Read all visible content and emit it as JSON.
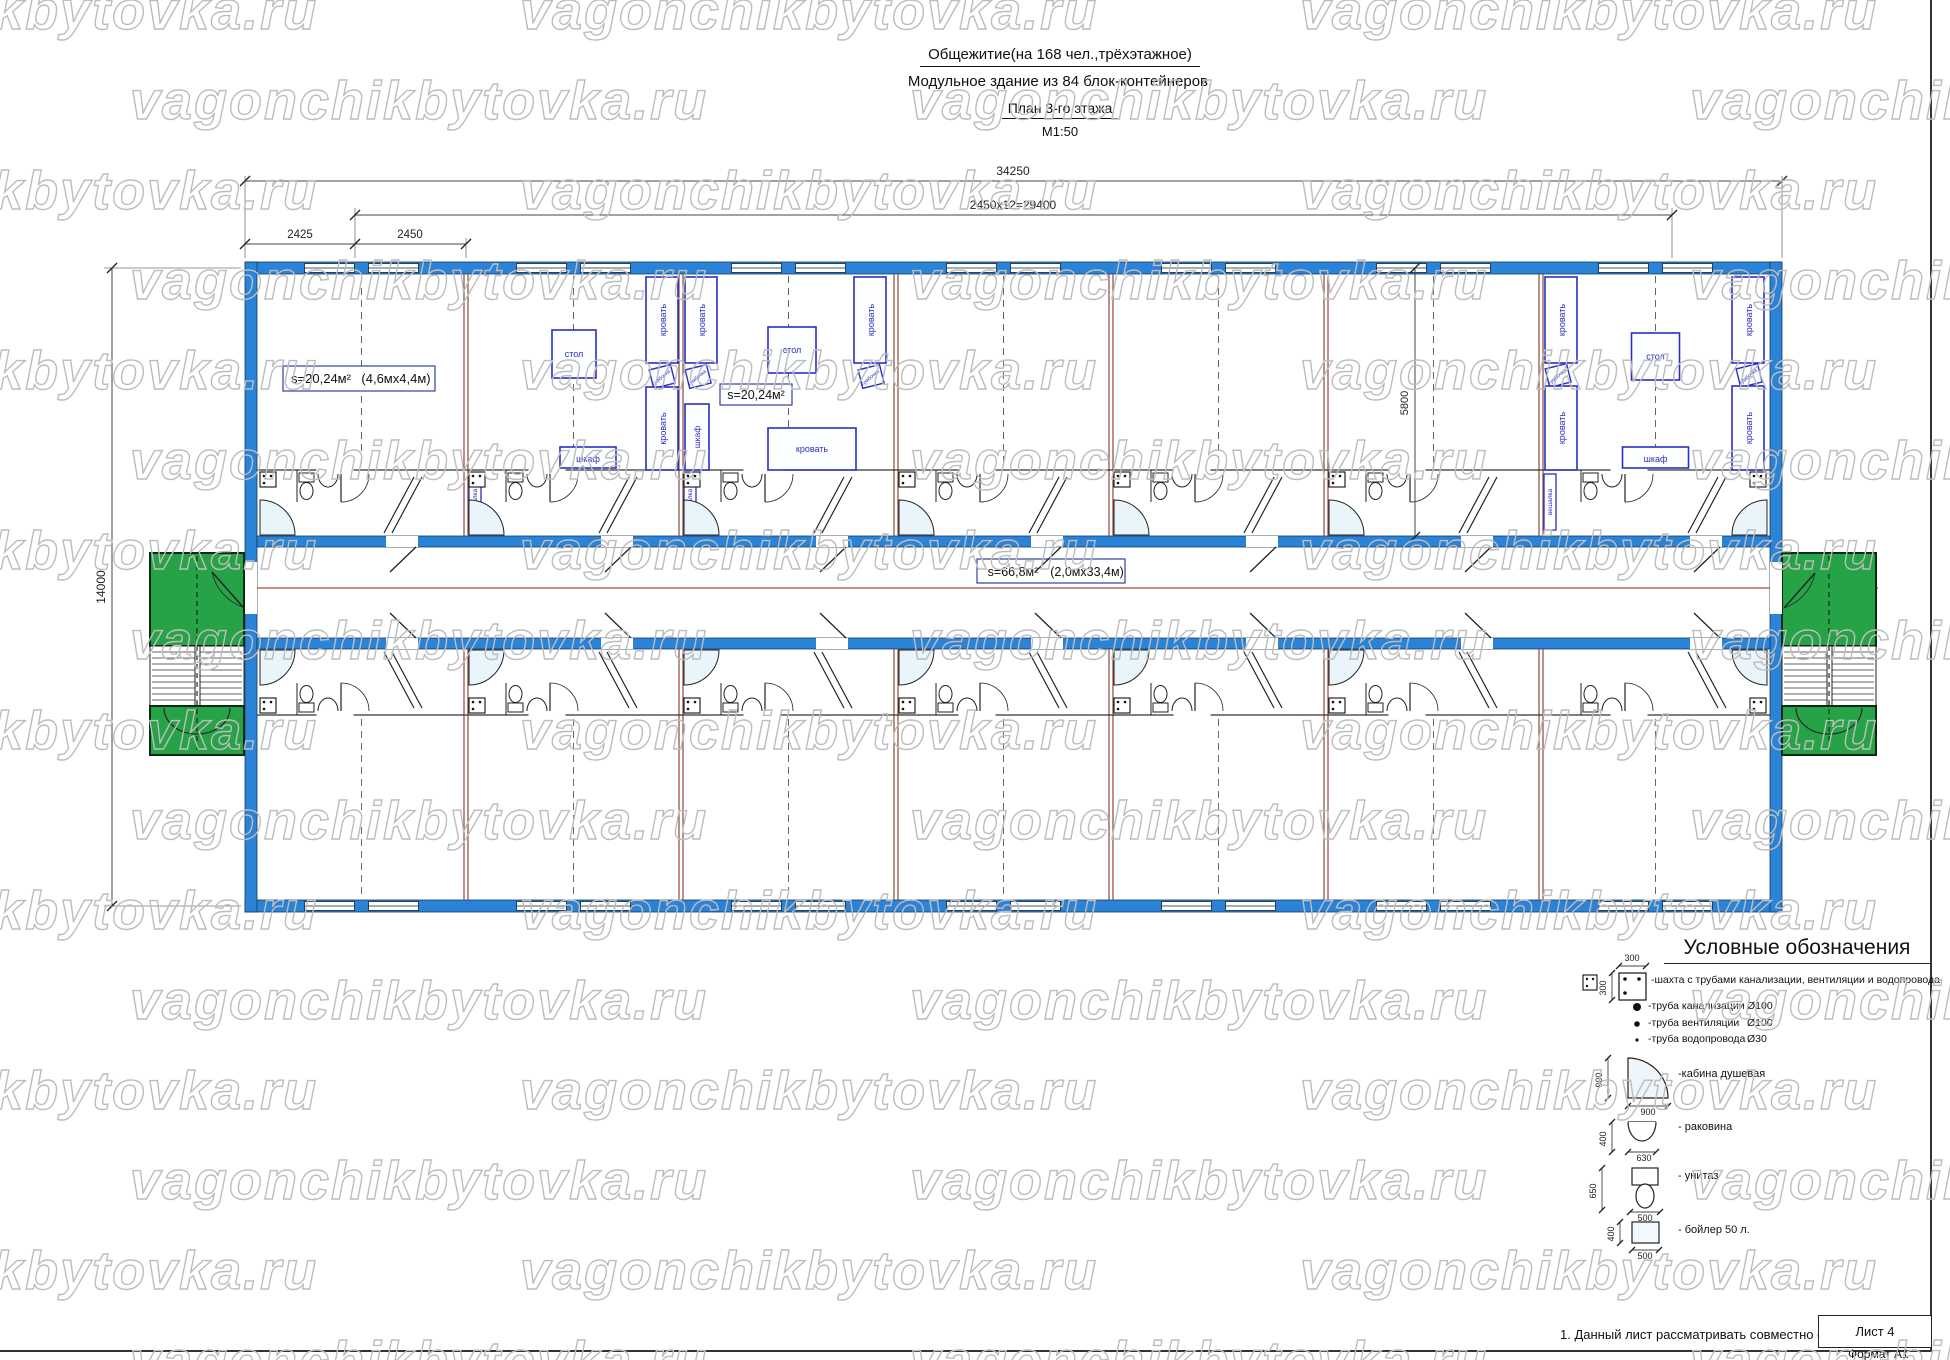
{
  "title": {
    "line1": "Общежитие(на 168 чел.,трёхэтажное)",
    "line2": "Модульное здание из 84 блок-контейнеров.",
    "line3": "План 3-го этажа",
    "line4": "М1:50"
  },
  "watermark": "vagonchikbytovka.ru",
  "dims": {
    "total": "34250",
    "modules": "2450x12=29400",
    "end_module": "2425",
    "module": "2450",
    "building_depth": "14000",
    "room_depth": "5800"
  },
  "labels": {
    "room1_area": "s=20,24м²",
    "room1_size": "(4,6мх4,4м)",
    "room2_area": "s=20,24м²",
    "corridor_area": "s=66,8м²",
    "corridor_size": "(2,0мх33,4м)"
  },
  "furniture": {
    "bed": "кровать",
    "table": "стол",
    "wardrobe": "шкаф",
    "nightstand": "тумбочка",
    "hanger": "вешалка"
  },
  "legend": {
    "title": "Условные обозначения",
    "shaft_label": "-шахта с трубами канализации, вентиляции и водопровода",
    "shaft_dim_w": "300",
    "shaft_dim_h": "300",
    "pipes": [
      {
        "label": "-труба канализации",
        "dia": "Ø100"
      },
      {
        "label": "-труба вентиляции",
        "dia": "Ø100"
      },
      {
        "label": "-труба водопровода",
        "dia": "Ø30"
      }
    ],
    "fixtures": [
      {
        "label": "-кабина душевая",
        "dim_w": "900",
        "dim_h": "900"
      },
      {
        "label": "- раковина",
        "dim_w": "630",
        "dim_h": "400"
      },
      {
        "label": "- унитаз",
        "dim_w": "500",
        "dim_h": "650"
      },
      {
        "label": "- бойлер 50 л.",
        "dim_w": "500",
        "dim_h": "400"
      }
    ]
  },
  "footer": {
    "note": "1. Данный лист рассматривать совместно с листом 1",
    "sheet": "Лист 4",
    "format": "Формат А1"
  },
  "colors": {
    "wall": "#2b83d8",
    "wall_edge": "#0e3a66",
    "furniture": "#2a2ec4",
    "green": "#27a347",
    "axis": "#b04a3c",
    "partition": "#8a4a3a",
    "line": "#333333",
    "watermark": "#bdbdbd"
  }
}
